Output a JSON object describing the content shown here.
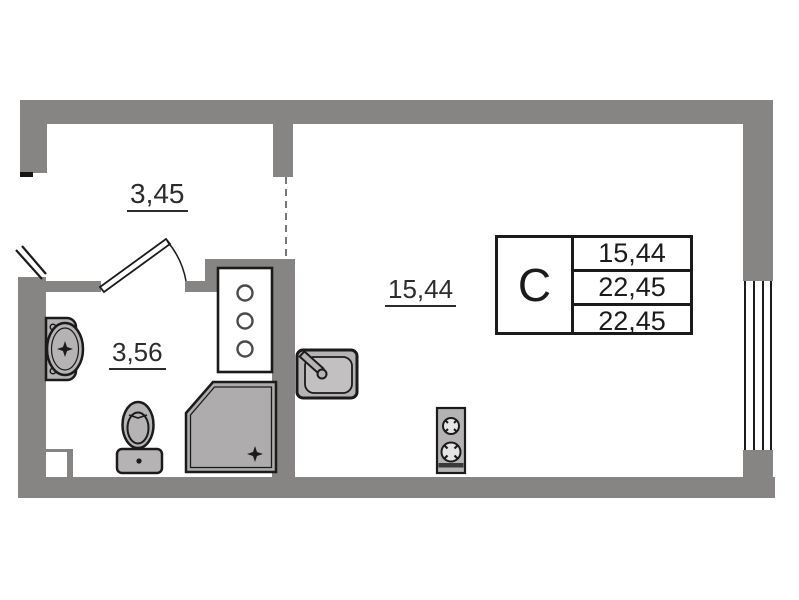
{
  "labels": {
    "hallway_area": "3,45",
    "bathroom_area": "3,56",
    "main_room_area": "15,44"
  },
  "legend": {
    "unit_type": "C",
    "rows": [
      "15,44",
      "22,45",
      "22,45"
    ]
  },
  "colors": {
    "wall": "#878484",
    "fixture": "#b5b3b3",
    "fixture-light": "#c2c0c0",
    "shower": "#aeacac",
    "line": "#1b1b1b",
    "background": "#ffffff"
  },
  "fixtures": [
    "washbasin",
    "toilet",
    "shower-cabin",
    "kitchen-sink",
    "two-burner-stove",
    "utility-cabinet",
    "window",
    "entry-door",
    "bathroom-door",
    "radiator-window-lines"
  ]
}
